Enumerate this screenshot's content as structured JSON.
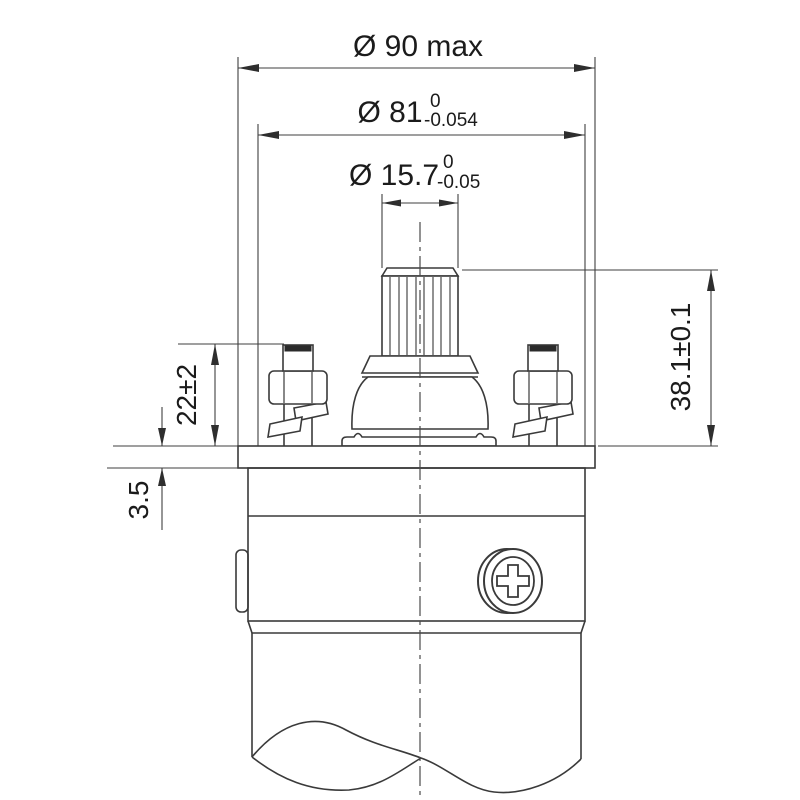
{
  "drawing": {
    "dim_d90_label": "Ø 90 max",
    "dim_d81_main": "Ø 81",
    "dim_d81_tol_upper": "0",
    "dim_d81_tol_lower": "-0.054",
    "dim_d157_main": "Ø 15.7",
    "dim_d157_tol_upper": "0",
    "dim_d157_tol_lower": "-0.05",
    "dim_h381": "38.1±0.1",
    "dim_h22": "22±2",
    "dim_h35": "3.5"
  },
  "colors": {
    "line": "#3a3a3a",
    "text": "#1b1b1b",
    "background": "#ffffff"
  }
}
